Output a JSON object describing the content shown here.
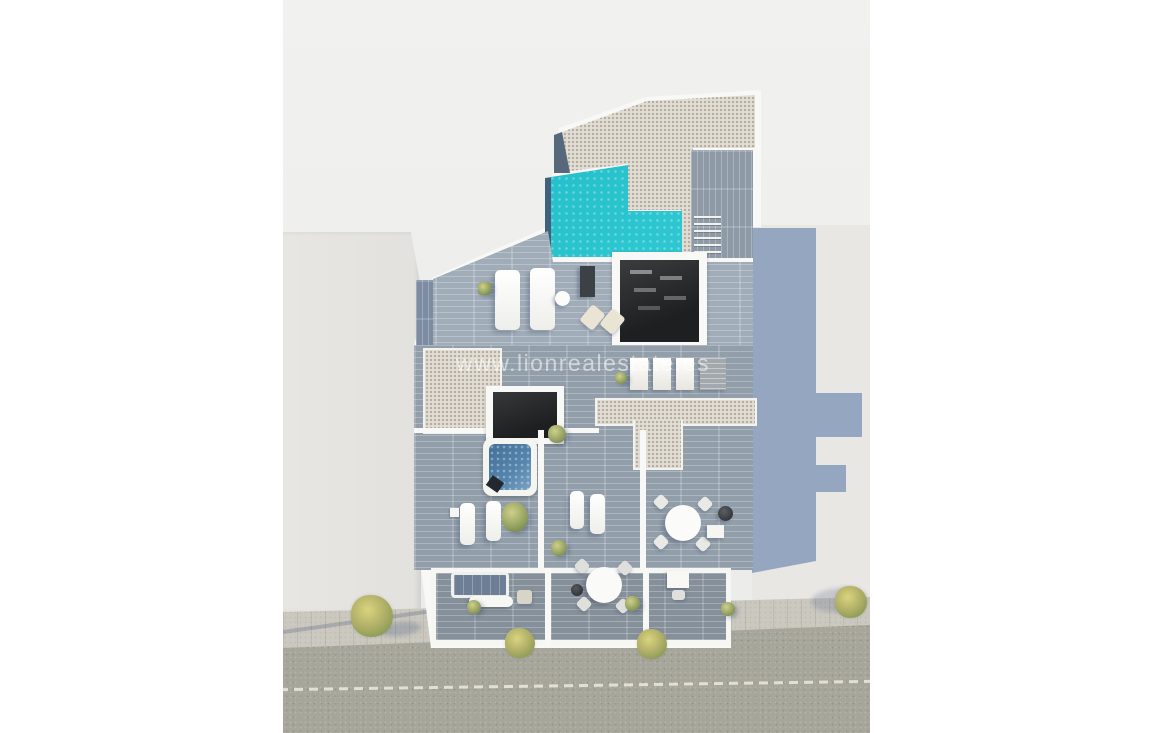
{
  "image": {
    "kind": "3d-architectural-render",
    "view": "aerial-top-down",
    "subject": "New-build apartment building with rooftop pool, sun terraces and street frontage, flanked by neighbouring buildings",
    "watermark": "www.lionrealestate.es"
  },
  "features": [
    "rooftop-gravel-roof",
    "rooftop-swimming-pool",
    "wooden-pool-deck-with-staircase",
    "rooftop-terrace-with-sun-beds",
    "open-stairwell-atrium",
    "air-conditioning-units",
    "jacuzzi-hot-tub",
    "terraces-with-sun-loungers",
    "outdoor-dining-table",
    "barbecue",
    "ground-floor-terraces",
    "garden-sofa",
    "sidewalk-with-trees",
    "street-with-dashed-centerline",
    "neighbouring-buildings",
    "building-shadow"
  ],
  "colors": {
    "canvas": "#ffffff",
    "render-bg": "#eeeeec",
    "building-white": "#f8f8f6",
    "gravel": "#e2ded5",
    "pool-water": "#2cc6d0",
    "pool-water-deep": "#12aebc",
    "jacuzzi-water": "#5585ad",
    "deck-wood": "#a9b5c1",
    "shadow-blue": "#8397ba",
    "stairwell-dark": "#1d1f21",
    "asphalt": "#a7a69b",
    "sidewalk": "#cbc8bf",
    "lane-marking": "#e2dfd6",
    "tree": "#b3b169"
  }
}
